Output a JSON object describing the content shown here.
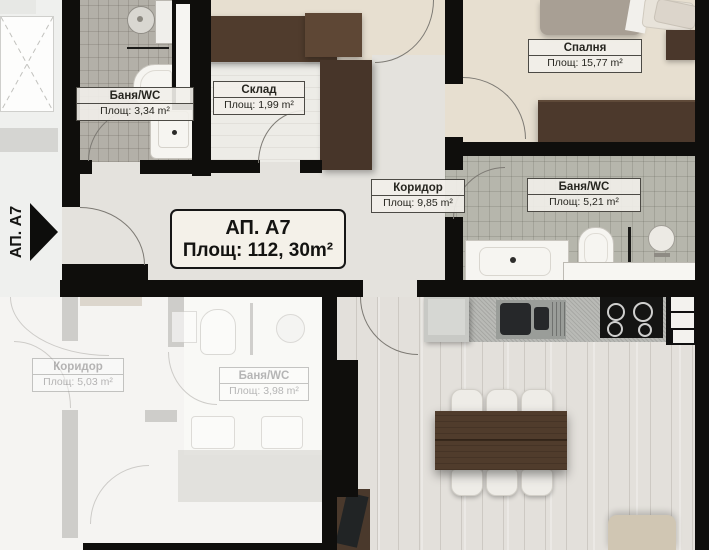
{
  "plan": {
    "entrance": {
      "label": "АП. А7"
    },
    "main_label": {
      "title": "АП. А7",
      "area": "Площ: 112, 30m²"
    },
    "rooms": [
      {
        "name": "Баня/WC",
        "area": "Площ: 3,34 m²"
      },
      {
        "name": "Склад",
        "area": "Площ: 1,99 m²"
      },
      {
        "name": "Спалня",
        "area": "Площ: 15,77 m²"
      },
      {
        "name": "Коридор",
        "area": "Площ: 9,85 m²"
      },
      {
        "name": "Баня/WC",
        "area": "Площ: 5,21 m²"
      },
      {
        "name": "Коридор",
        "area": "Площ: 5,03 m²"
      },
      {
        "name": "Баня/WC",
        "area": "Площ: 3,98 m²"
      }
    ],
    "colors": {
      "wall": "#0f0e0c",
      "floor_beige": "#e7dfd0",
      "floor_tile": "#b3b0a8",
      "floor_wood": "#e3e0db",
      "furniture_brown": "#4b392c"
    }
  }
}
